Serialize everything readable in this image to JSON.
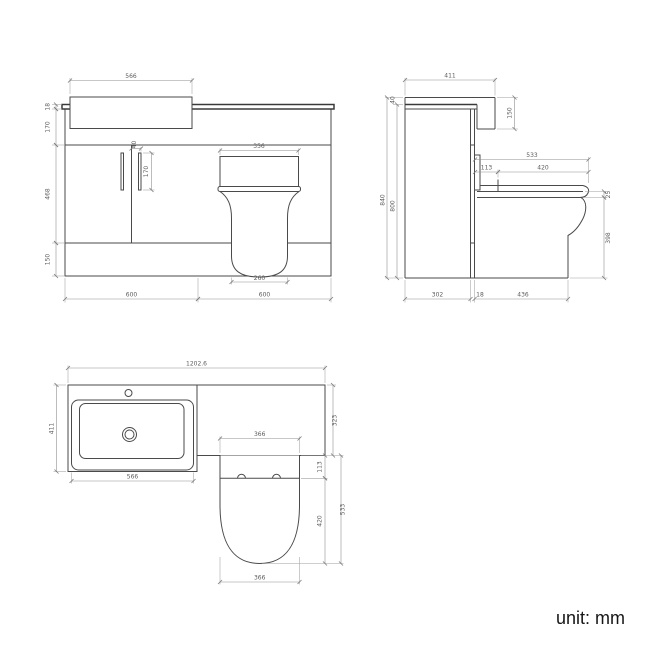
{
  "unit_label": "unit: mm",
  "views": {
    "front": {
      "basin_width": "566",
      "worktop_thickness": "18",
      "apron_height": "170",
      "door_height": "468",
      "plinth_height": "150",
      "handle_offset": "40",
      "handle_length": "170",
      "cistern_width": "356",
      "pan_base_width": "260",
      "vanity_width": "600",
      "wc_unit_width": "600"
    },
    "side": {
      "depth": "411",
      "basin_above_top": "40",
      "total_height": "840",
      "cabinet_height": "800",
      "basin_height": "150",
      "seat_total_depth": "533",
      "seat_back_offset": "113",
      "seat_length": "420",
      "seat_thickness": "25",
      "pan_height": "398",
      "cabinet_depth": "302",
      "panel_thickness": "18",
      "pan_projection": "436"
    },
    "plan": {
      "total_width": "1202.6",
      "vanity_depth": "411",
      "basin_width": "566",
      "wc_top_depth": "323",
      "seat_back_offset": "113",
      "seat_length": "420",
      "seat_total_depth": "533",
      "toilet_width": "366",
      "pan_width": "366"
    }
  }
}
